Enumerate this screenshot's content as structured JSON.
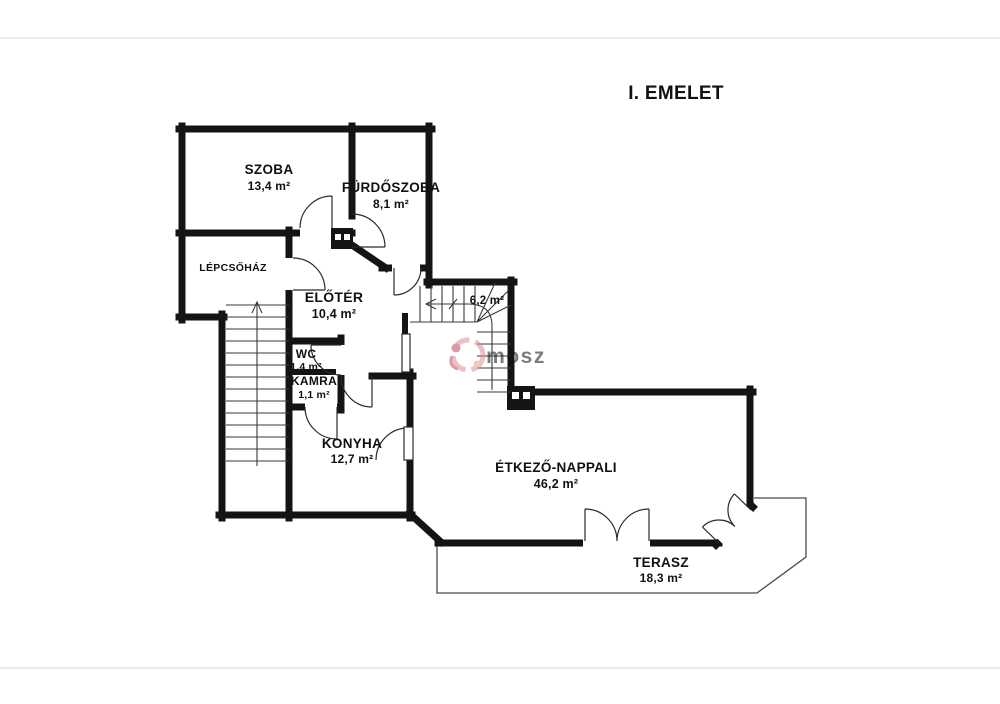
{
  "title": "I. EMELET",
  "watermark": {
    "text": "mosz"
  },
  "rooms": [
    {
      "id": "szoba",
      "name": "SZOBA",
      "area": "13,4 m²"
    },
    {
      "id": "furdoszoba",
      "name": "FÜRDŐSZOBA",
      "area": "8,1 m²"
    },
    {
      "id": "lepcsohaz",
      "name": "LÉPCSŐHÁZ",
      "area": ""
    },
    {
      "id": "eloter",
      "name": "ELŐTÉR",
      "area": "10,4 m²"
    },
    {
      "id": "lepcso",
      "name": "",
      "area": "6,2 m²"
    },
    {
      "id": "wc",
      "name": "WC",
      "area": "1,4 m²"
    },
    {
      "id": "kamra",
      "name": "KAMRA",
      "area": "1,1 m²"
    },
    {
      "id": "konyha",
      "name": "KONYHA",
      "area": "12,7 m²"
    },
    {
      "id": "etkezo",
      "name": "ÉTKEZŐ-NAPPALI",
      "area": "46,2 m²"
    },
    {
      "id": "terasz",
      "name": "TERASZ",
      "area": "18,3 m²"
    }
  ]
}
